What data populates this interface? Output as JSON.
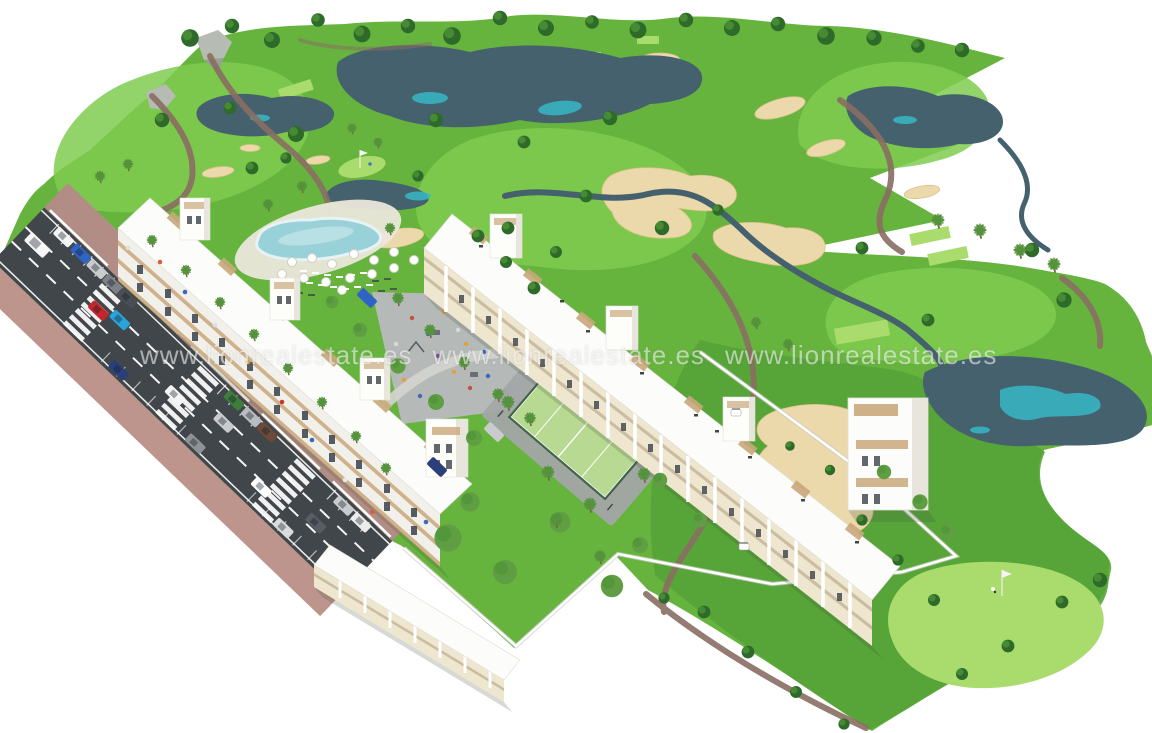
{
  "watermark": {
    "text": "www.lionrealestate.es"
  },
  "palette": {
    "background": "#ffffff",
    "fairway": "#66b43e",
    "fairway_light": "#7fcb50",
    "rough_dark": "#55a337",
    "green_bright": "#a9dc6d",
    "sand": "#ecd9ab",
    "water_dark": "#45616e",
    "water_teal": "#37b7c6",
    "path_brown": "#8a6e63",
    "road_asphalt": "#41464b",
    "road_line": "#ffffff",
    "sidewalk": "#b28d86",
    "sidewalk_light": "#bd958d",
    "building_white": "#fcfcfa",
    "facade_white": "#f2f0ea",
    "facade_cream": "#efe6cf",
    "building_accent": "#c9a87b",
    "building_shade": "#e7e5dc",
    "window_dark": "#39414a",
    "pool_water": "#99d1d9",
    "pool_deck": "#ebe7db",
    "padel_court": "#b7d992",
    "padel_fence": "#3c5f45",
    "plaza_gray": "#b9bbbf",
    "tree_dark": "#2e6b2b",
    "tree_garden": "#5f9e43",
    "palm_green": "#55923c",
    "wall_white": "#ffffff"
  },
  "road": {
    "cars": [
      "#f3f4f4",
      "#2f63c4",
      "#c9cbcd",
      "#7e8287",
      "#4a4f55",
      "#3f7d3a",
      "#babdbf",
      "#6b4a38",
      "#c9cbcd",
      "#ececec",
      "#2a3f7a",
      "#8f9296",
      "#dadbdc",
      "#c1272d",
      "#2aa4d8",
      "#f5f5f5",
      "#c9cbcd",
      "#ffffff",
      "#585d63",
      "#f7f7f7"
    ]
  },
  "driveway": {
    "cars": [
      "#2f63c4",
      "#2a3f7a",
      "#c9cbcd"
    ]
  }
}
